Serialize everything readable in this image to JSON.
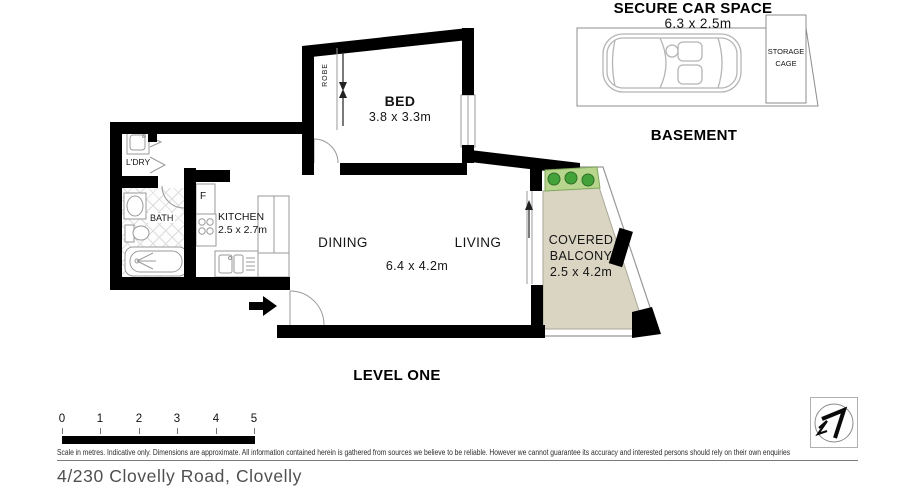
{
  "address": "4/230 Clovelly Road, Clovelly",
  "plan": {
    "level_label": "LEVEL ONE",
    "bed": {
      "label": "BED",
      "dims": "3.8 x 3.3m"
    },
    "robe_label": "ROBE",
    "ldry_label": "L'DRY",
    "bath_label": "BATH",
    "fridge_label": "F",
    "kitchen": {
      "label": "KITCHEN",
      "dims": "2.5 x 2.7m"
    },
    "dining_label": "DINING",
    "living_label": "LIVING",
    "living_dining_dims": "6.4 x 4.2m",
    "balcony": {
      "line1": "COVERED",
      "line2": "BALCONY",
      "dims": "2.5 x 4.2m"
    }
  },
  "basement": {
    "label": "BASEMENT",
    "car_space_label": "SECURE CAR SPACE",
    "car_space_dims": "6.3 x 2.5m",
    "storage_line1": "STORAGE",
    "storage_line2": "CAGE"
  },
  "scale_bar": {
    "ticks": [
      "0",
      "1",
      "2",
      "3",
      "4",
      "5"
    ]
  },
  "disclaimer": "Scale in metres. Indicative only. Dimensions are approximate. All information contained herein is gathered from sources we believe to be reliable. However we cannot guarantee its accuracy and interested persons should rely on their own enquiries",
  "colors": {
    "wall_black": "#000000",
    "line_gray": "#999999",
    "balcony_floor": "#d9d5c2",
    "planter_green": "#b7d58d",
    "plant_green": "#43a23a"
  }
}
